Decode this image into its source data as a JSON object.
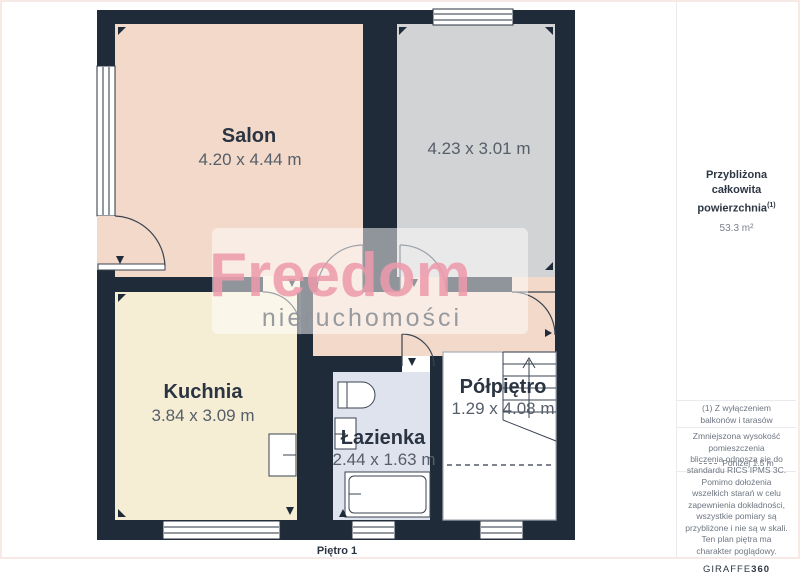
{
  "floor_label": "Piętro 1",
  "watermark": {
    "brand": "Freedom",
    "sub": "nieruchomości"
  },
  "rooms": {
    "salon": {
      "name": "Salon",
      "dims": "4.20 x 4.44 m"
    },
    "room_top": {
      "name": "",
      "dims": "4.23 x 3.01 m"
    },
    "kuchnia": {
      "name": "Kuchnia",
      "dims": "3.84 x 3.09 m"
    },
    "lazienka": {
      "name": "Łazienka",
      "dims": "2.44 x 1.63 m"
    },
    "polpietro": {
      "name": "Półpiętro",
      "dims": "1.29 x 4.08 m"
    }
  },
  "sidebar": {
    "total_area_label": "Przybliżona całkowita powierzchnia",
    "total_area_superscript": "(1)",
    "total_area_value": "53.3 m²",
    "footnote": "(1) Z wyłączeniem balkonów i tarasów",
    "reduced_height_label": "Zmniejszona wysokość pomieszczenia",
    "reduced_height_value": "Poniżej 1.5 m",
    "disclaimer": "bliczenia odnoszą się do standardu RICS IPMS 3C. Pomimo dołożenia wszelkich starań w celu zapewnienia dokładności, wszystkie pomiary są przybliżone i nie są w skali. Ten plan piętra ma charakter poglądowy.",
    "logo_text": "GIRAFFE",
    "logo_suffix": "360"
  },
  "colors": {
    "wall": "#202b39",
    "salon_fill": "#f2d9c9",
    "gray_room_fill": "#d2d3d4",
    "kitchen_fill": "#f6edd5",
    "bath_fill": "#dfe3ee",
    "watermark_pink": "#ee9aab",
    "label_dark": "#2b3442",
    "dims_gray": "#555e69"
  }
}
